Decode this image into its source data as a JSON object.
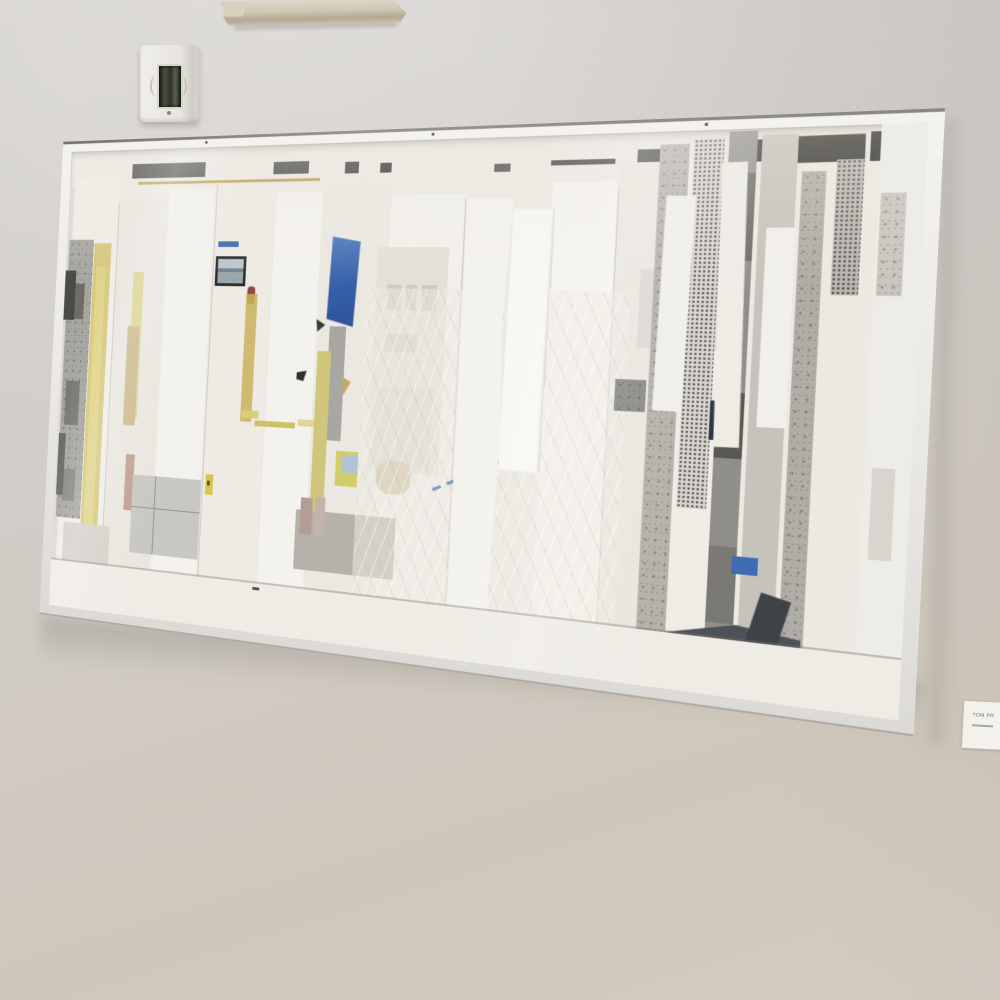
{
  "scene": {
    "description": "Photograph of a gallery wall: large horizontal abstract white paper collage in a thin white metal box frame, viewed at an angle; ceiling light fixture top edge, wall switch box upper left, small exhibition label card at right edge"
  },
  "label_card": {
    "line1": "TOM PR"
  },
  "colors": {
    "wall": "#d1cdc7",
    "wall_warm_bottom": "#cfc7bb",
    "canvas_base": "#ece9e2",
    "frame_face": "#eae9e5",
    "frame_edge_dark": "#8a8781",
    "frame_side": "#eeeeec",
    "accent_blue": "#3c68b0",
    "accent_yellow": "#d6c87e",
    "accent_tan": "#cbb98c",
    "accent_rose": "#c29f92",
    "charcoal": "#44464a",
    "slate": "#4d5158",
    "halftone_gray": "#6b6b68",
    "fixture_beige": "#cfc7b3",
    "switch_body": "#e9e7e2",
    "switch_glass": "#34382e",
    "label_bg": "#f3f1ec",
    "label_text": "#6e6c68",
    "shadow": "rgba(92,86,77,0.26)"
  }
}
